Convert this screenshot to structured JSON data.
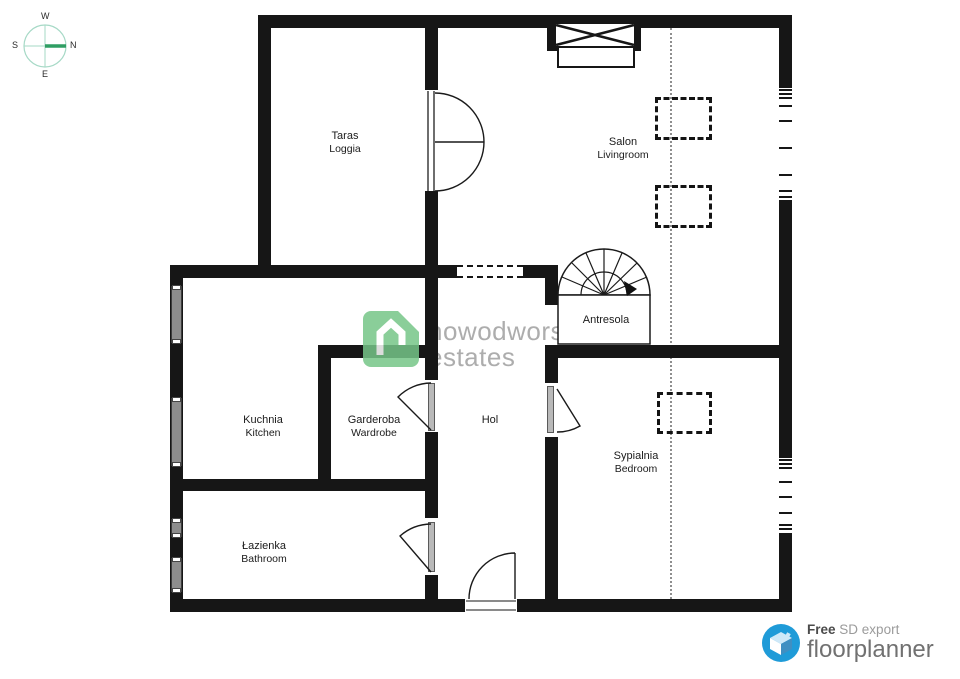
{
  "compass": {
    "w": "W",
    "s": "S",
    "n": "N",
    "e": "E"
  },
  "rooms": {
    "taras": {
      "name": "Taras",
      "name_en": "Loggia"
    },
    "salon": {
      "name": "Salon",
      "name_en": "Livingroom"
    },
    "antresola": {
      "name": "Antresola"
    },
    "kuchnia": {
      "name": "Kuchnia",
      "name_en": "Kitchen"
    },
    "garderoba": {
      "name": "Garderoba",
      "name_en": "Wardrobe"
    },
    "hol": {
      "name": "Hol"
    },
    "sypialnia": {
      "name": "Sypialnia",
      "name_en": "Bedroom"
    },
    "lazienka": {
      "name": "Łazienka",
      "name_en": "Bathroom"
    }
  },
  "watermark": {
    "line1": "nowodworski",
    "line2": "estates",
    "brand_green": "#76c688",
    "text_gray": "#adadad"
  },
  "footer": {
    "free": "Free",
    "export": "SD export",
    "brand": "floorplanner",
    "brand_blue": "#1f9bd8"
  },
  "colors": {
    "wall": "#161616",
    "window_gray": "#8d8d8d",
    "dotted_line": "#8f8f8f"
  }
}
